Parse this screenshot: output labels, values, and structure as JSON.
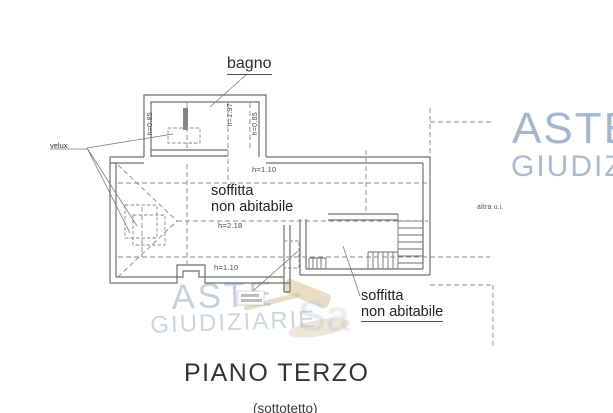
{
  "drawing": {
    "room_labels": {
      "bagno": "bagno",
      "velux": "velux",
      "soffitta_main": {
        "line1": "soffitta",
        "line2": "non abitabile"
      },
      "soffitta_right": {
        "line1": "soffitta",
        "line2": "non abitabile"
      },
      "altra_ui": "altra u.i."
    },
    "dimensions": {
      "bagno_left_height": "h=0.85",
      "bagno_center_height": "h=1.97",
      "bagno_right_height": "h=0.85",
      "upper_right_height": "h=1.10",
      "attic_center_height": "h=2.18",
      "attic_bottom_height": "h=1.10"
    }
  },
  "footer": {
    "floor_title": "PIANO TERZO",
    "floor_subtitle": "(sottotetto)"
  },
  "watermarks": {
    "right": {
      "line1": "ASTE",
      "line2": "GIUDIZIARIE"
    },
    "bottom_left": {
      "line1": "ASTE",
      "line2": "GIUDIZIARIE"
    },
    "color_blue": "#94aac6",
    "color_tan": "#d5c196"
  }
}
